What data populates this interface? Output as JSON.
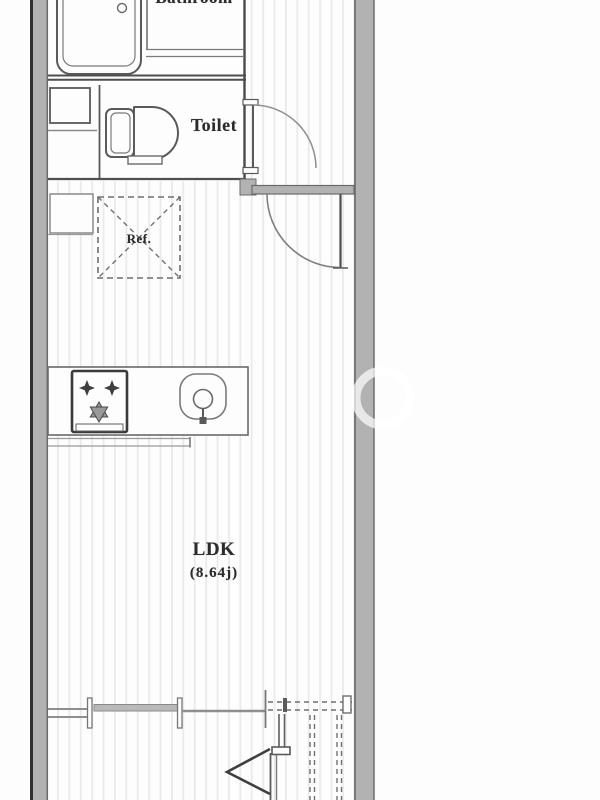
{
  "floor_plan": {
    "labels": {
      "bathroom": "Bathroom",
      "toilet": "Toilet",
      "refrigerator": "Ref.",
      "living_room": "LDK",
      "living_room_size": "(8.64j)"
    },
    "colors": {
      "background": "#fdfdfd",
      "wall_fill": "#b2b2b2",
      "wall_outer_edge": "#2f2f2f",
      "wall_inner_edge": "#6a6a6a",
      "fixture_line_dark": "#4f4f4f",
      "fixture_line_medium": "#8a8a8a",
      "floor_stripe": "#eaeaea",
      "label_text": "#2b2b2b",
      "window_glazing": "#b9b9b9"
    }
  }
}
